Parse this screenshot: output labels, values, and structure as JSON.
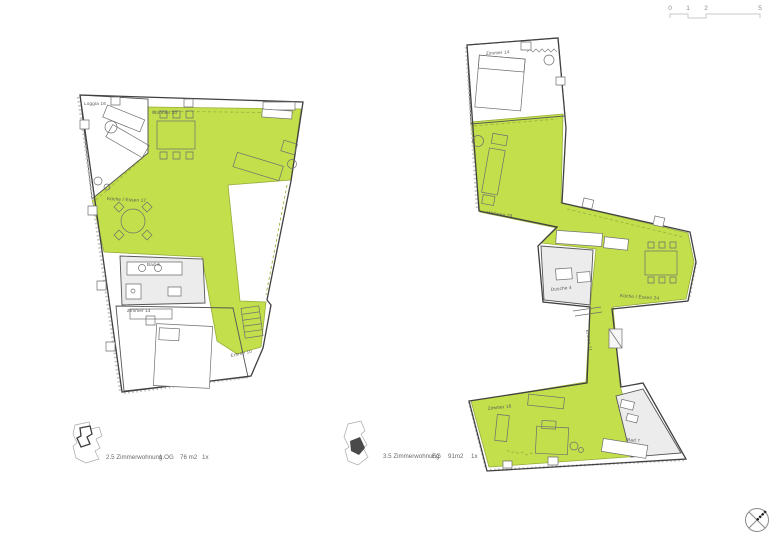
{
  "scale_bar": {
    "ticks": [
      "0",
      "1",
      "2",
      "5"
    ]
  },
  "colors": {
    "highlight": "#c3df4b"
  },
  "plan_left": {
    "rooms": {
      "loggia": "Loggia 16",
      "wohnen": "Wohnen 20",
      "kueche_essen": "Küche / Essen 17",
      "bad": "Bad 6",
      "zimmer": "Zimmer 14",
      "entree": "Entree 10"
    },
    "caption": {
      "type": "2.5 Zimmerwohnung",
      "floor": "1.OG",
      "area": "76 m2",
      "count": "1x"
    }
  },
  "plan_right": {
    "rooms": {
      "zimmer_top": "Zimmer 14",
      "wohnen": "Wohnen 19",
      "kueche_essen": "Küche / Essen 24",
      "dusche": "Dusche 4",
      "entree": "Entree 11",
      "zimmer_bottom": "Zimmer 16",
      "bad": "Bad 7"
    },
    "caption": {
      "type": "3.5 Zimmerwohnung",
      "floor": "EG",
      "area": "91m2",
      "count": "1x"
    }
  }
}
